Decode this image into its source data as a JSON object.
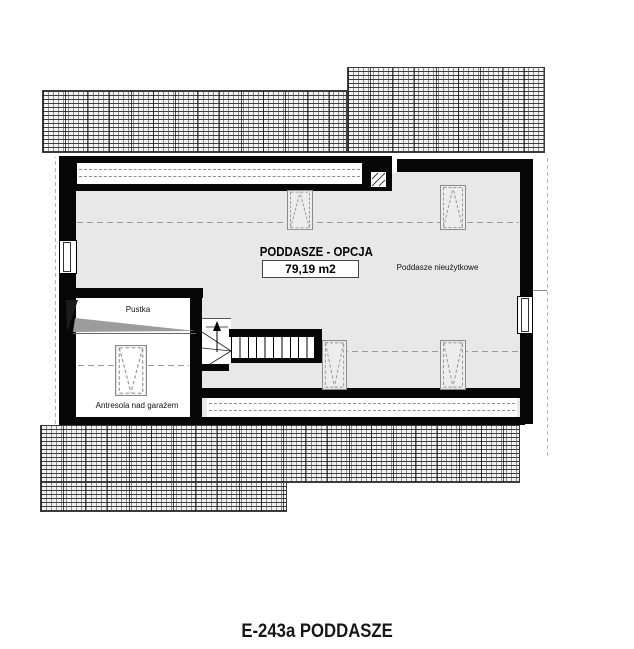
{
  "plan": {
    "room_label": "PODDASZE - OPCJA",
    "room_area": "79,19 m2",
    "note_unusable": "Poddasze nieużytkowe",
    "note_void": "Pustka",
    "note_mezzanine": "Antresola nad garażem",
    "caption": "E-243a PODDASZE",
    "colors": {
      "wall": "#070707",
      "floor_fill": "#e8e8e8",
      "roof_hatch_line": "#3c3c3c",
      "dash_line": "#9a9a9a"
    }
  }
}
